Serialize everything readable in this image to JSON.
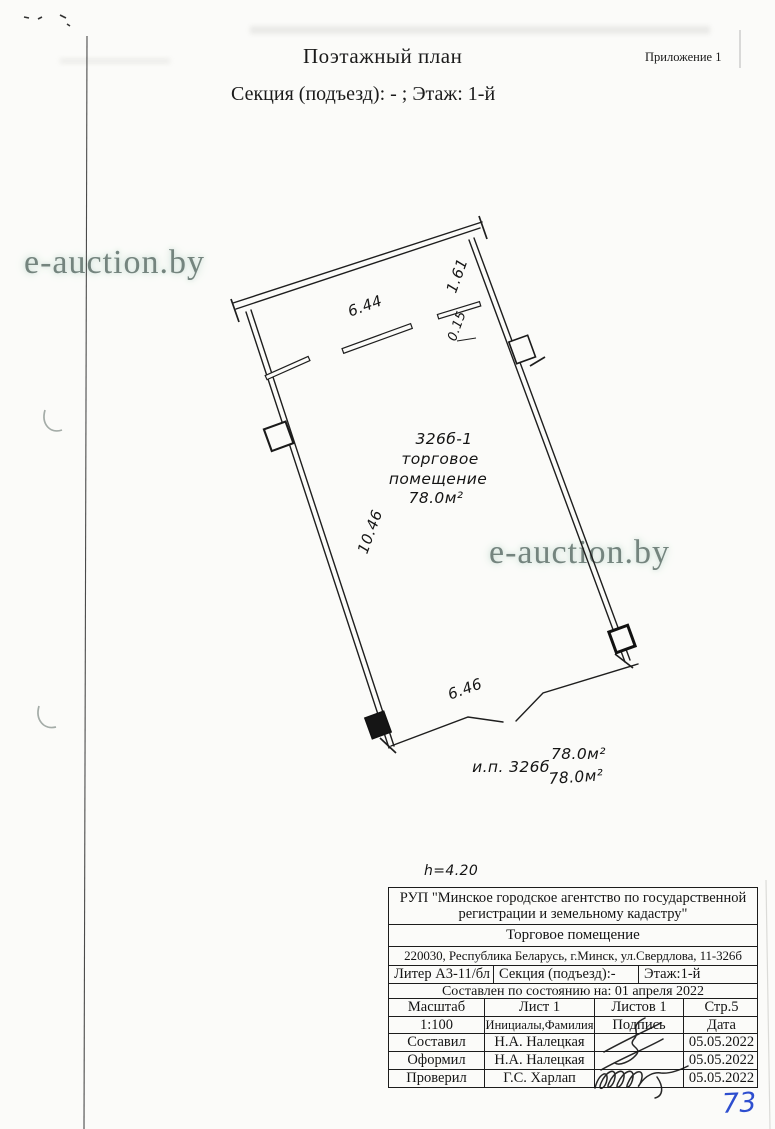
{
  "page": {
    "title": "Поэтажный план",
    "appendix": "Приложение 1",
    "subtitle": "Секция (подъезд): - ;  Этаж: 1-й",
    "handwritten_number": "73"
  },
  "watermark": {
    "text": "e-auction.by",
    "color": "#74847e"
  },
  "plan": {
    "dimensions": {
      "top": "6.44",
      "right_upper": "1.61",
      "partition": "0.15",
      "left": "10.46",
      "bottom": "6.46"
    },
    "room": {
      "number": "326б-1",
      "type_line1": "торговое",
      "type_line2": "помещение",
      "area": "78.0м²"
    },
    "unit": {
      "label": "и.п. 326б",
      "area1": "78.0м²",
      "area2": "78.0м²"
    },
    "height_note": "h=4.20"
  },
  "table": {
    "org": "РУП \"Минское городское агентство по государственной регистрации и земельному кадастру\"",
    "object_type": "Торговое помещение",
    "address": "220030, Республика Беларусь, г.Минск, ул.Свердлова, 11-326б",
    "liter": "Литер А3-11/бл",
    "section": "Секция (подъезд):-",
    "floor": "Этаж:1-й",
    "as_of": "Составлен по состоянию на: 01 апреля 2022",
    "scale_label": "Масштаб",
    "sheet": "Лист 1",
    "sheets": "Листов 1",
    "page_ref": "Стр.5",
    "scale_value": "1:100",
    "name_header": "Инициалы,Фамилия",
    "sign_header": "Подпись",
    "date_header": "Дата",
    "rows": [
      {
        "role": "Составил",
        "name": "Н.А. Налецкая",
        "date": "05.05.2022"
      },
      {
        "role": "Оформил",
        "name": "Н.А. Налецкая",
        "date": "05.05.2022"
      },
      {
        "role": "Проверил",
        "name": "Г.С. Харлап",
        "date": "05.05.2022"
      }
    ]
  }
}
